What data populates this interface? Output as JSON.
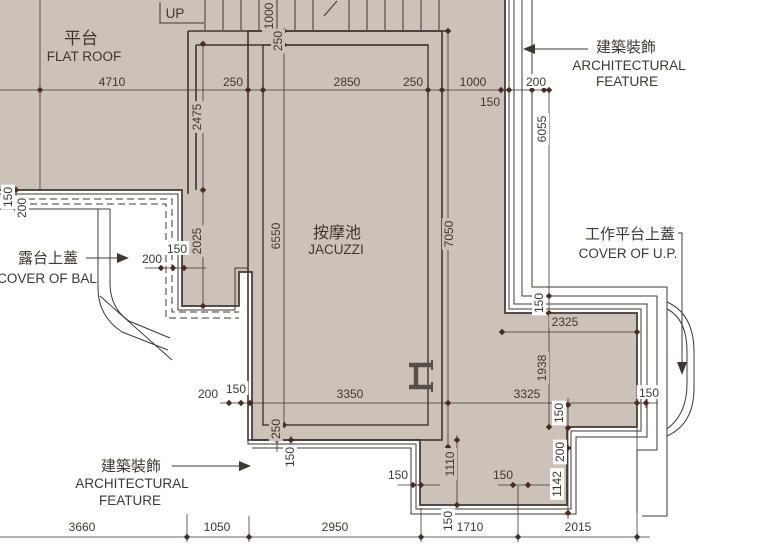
{
  "drawing": {
    "kind": "architectural-floor-plan"
  },
  "colors": {
    "fill": "#ccc2b9",
    "line": "#3e3731",
    "tick": "#4a2c20",
    "white": "#ffffff"
  },
  "labels": [
    {
      "t": "平台",
      "x": 81,
      "y": 44,
      "s": 17,
      "cls": "room-label-flat-roof-zh"
    },
    {
      "t": "FLAT ROOF",
      "x": 84,
      "y": 61,
      "s": 13.5,
      "cls": "room-label-flat-roof-en"
    },
    {
      "t": "UP",
      "x": 175,
      "y": 18,
      "s": 13.5,
      "cls": "stair-up-label"
    },
    {
      "t": "按摩池",
      "x": 337,
      "y": 238,
      "s": 16,
      "cls": "room-label-jacuzzi-zh"
    },
    {
      "t": "JACUZZI",
      "x": 336,
      "y": 254,
      "s": 13.5,
      "cls": "room-label-jacuzzi-en"
    },
    {
      "t": "建築裝飾",
      "x": 626,
      "y": 52,
      "s": 15,
      "cls": "annotation-arch-feature-top-zh"
    },
    {
      "t": "ARCHITECTURAL",
      "x": 629,
      "y": 70,
      "s": 13.5,
      "cls": "annotation-arch-feature-top-en1"
    },
    {
      "t": "FEATURE",
      "x": 627,
      "y": 86,
      "s": 13.5,
      "cls": "annotation-arch-feature-top-en2"
    },
    {
      "t": "露台上蓋",
      "x": 48,
      "y": 263,
      "s": 15,
      "cls": "annotation-cover-of-bal-zh"
    },
    {
      "t": "COVER OF BAL",
      "x": 47,
      "y": 283,
      "s": 13.5,
      "cls": "annotation-cover-of-bal-en"
    },
    {
      "t": "工作平台上蓋",
      "x": 630,
      "y": 239,
      "s": 15,
      "cls": "annotation-cover-of-up-zh"
    },
    {
      "t": "COVER OF U.P.",
      "x": 628,
      "y": 258,
      "s": 13.5,
      "cls": "annotation-cover-of-up-en"
    },
    {
      "t": "建築裝飾",
      "x": 131,
      "y": 471,
      "s": 15,
      "cls": "annotation-arch-feature-bottom-zh"
    },
    {
      "t": "ARCHITECTURAL",
      "x": 132,
      "y": 488,
      "s": 13.5,
      "cls": "annotation-arch-feature-bottom-en1"
    },
    {
      "t": "FEATURE",
      "x": 130,
      "y": 505,
      "s": 13.5,
      "cls": "annotation-arch-feature-bottom-en2"
    }
  ],
  "dim_labels": [
    {
      "t": "4710",
      "x": 112,
      "y": 86,
      "bg": "f"
    },
    {
      "t": "250",
      "x": 233,
      "y": 86,
      "bg": "f"
    },
    {
      "t": "2850",
      "x": 347,
      "y": 86,
      "bg": "f"
    },
    {
      "t": "250",
      "x": 413,
      "y": 86,
      "bg": "f"
    },
    {
      "t": "1000",
      "x": 473,
      "y": 86,
      "bg": "f"
    },
    {
      "t": "200",
      "x": 536,
      "y": 86,
      "bg": "w"
    },
    {
      "t": "150",
      "x": 490,
      "y": 106,
      "bg": "f"
    },
    {
      "t": "2325",
      "x": 565,
      "y": 326,
      "bg": "f"
    },
    {
      "t": "200",
      "x": 208,
      "y": 398,
      "bg": "w"
    },
    {
      "t": "150",
      "x": 236,
      "y": 393,
      "bg": "w"
    },
    {
      "t": "3350",
      "x": 350,
      "y": 398,
      "bg": "f"
    },
    {
      "t": "3325",
      "x": 527,
      "y": 398,
      "bg": "f"
    },
    {
      "t": "150",
      "x": 649,
      "y": 397,
      "bg": "w"
    },
    {
      "t": "200",
      "x": 152,
      "y": 263,
      "bg": "w"
    },
    {
      "t": "150",
      "x": 177,
      "y": 253,
      "bg": "w"
    },
    {
      "t": "150",
      "x": 398,
      "y": 479,
      "bg": "w"
    },
    {
      "t": "150",
      "x": 503,
      "y": 479,
      "bg": "f"
    },
    {
      "t": "3660",
      "x": 82,
      "y": 531,
      "bg": "w"
    },
    {
      "t": "1050",
      "x": 217,
      "y": 531,
      "bg": "w"
    },
    {
      "t": "2950",
      "x": 335,
      "y": 531,
      "bg": "w"
    },
    {
      "t": "1710",
      "x": 470,
      "y": 531,
      "bg": "w"
    },
    {
      "t": "2015",
      "x": 578,
      "y": 531,
      "bg": "w"
    },
    {
      "t": "2475",
      "x": 197,
      "y": 117,
      "r": 1,
      "bg": "f"
    },
    {
      "t": "2025",
      "x": 197,
      "y": 241,
      "r": 1,
      "bg": "f"
    },
    {
      "t": "6550",
      "x": 276,
      "y": 236,
      "r": 1,
      "bg": "f"
    },
    {
      "t": "7050",
      "x": 449,
      "y": 234,
      "r": 1,
      "bg": "f"
    },
    {
      "t": "1000",
      "x": 269,
      "y": 16,
      "r": 1,
      "bg": "f"
    },
    {
      "t": "250",
      "x": 278,
      "y": 41,
      "r": 1,
      "bg": "f"
    },
    {
      "t": "6055",
      "x": 542,
      "y": 129,
      "r": 1,
      "bg": "w"
    },
    {
      "t": "150",
      "x": 539,
      "y": 303,
      "r": 1,
      "bg": "w"
    },
    {
      "t": "1938",
      "x": 542,
      "y": 368,
      "r": 1,
      "bg": "f"
    },
    {
      "t": "1110",
      "x": 450,
      "y": 464,
      "r": 1,
      "bg": "f"
    },
    {
      "t": "150",
      "x": 559,
      "y": 413,
      "r": 1,
      "bg": "w"
    },
    {
      "t": "200",
      "x": 560,
      "y": 452,
      "r": 1,
      "bg": "w"
    },
    {
      "t": "1142",
      "x": 557,
      "y": 484,
      "r": 1,
      "bg": "w"
    },
    {
      "t": "250",
      "x": 276,
      "y": 429,
      "r": 1,
      "bg": "f"
    },
    {
      "t": "150",
      "x": 290,
      "y": 457,
      "r": 1,
      "bg": "w"
    },
    {
      "t": "150",
      "x": 8,
      "y": 197,
      "r": 1,
      "bg": "w"
    },
    {
      "t": "200",
      "x": 22,
      "y": 208,
      "r": 1,
      "bg": "w"
    },
    {
      "t": "150",
      "x": 448,
      "y": 521,
      "r": 1,
      "bg": "w"
    }
  ],
  "ticks": [
    [
      40,
      90
    ],
    [
      248,
      90
    ],
    [
      263,
      90
    ],
    [
      428,
      90
    ],
    [
      442,
      90
    ],
    [
      501,
      90
    ],
    [
      509,
      90
    ],
    [
      532,
      90
    ],
    [
      544,
      90
    ],
    [
      229,
      403
    ],
    [
      241,
      403
    ],
    [
      250,
      403
    ],
    [
      448,
      403
    ],
    [
      637,
      403
    ],
    [
      646,
      403
    ],
    [
      161,
      268
    ],
    [
      173,
      268
    ],
    [
      184,
      268
    ],
    [
      187,
      537
    ],
    [
      249,
      537
    ],
    [
      421,
      537
    ],
    [
      518,
      537
    ],
    [
      637,
      537
    ],
    [
      203,
      44
    ],
    [
      203,
      190
    ],
    [
      203,
      306
    ],
    [
      284,
      31
    ],
    [
      284,
      45
    ],
    [
      284,
      425
    ],
    [
      448,
      31
    ],
    [
      448,
      447
    ],
    [
      549,
      90
    ],
    [
      549,
      296
    ],
    [
      549,
      313
    ],
    [
      549,
      427
    ],
    [
      502,
      332
    ],
    [
      637,
      332
    ],
    [
      568,
      405
    ],
    [
      568,
      428
    ],
    [
      568,
      448
    ],
    [
      568,
      513
    ],
    [
      16,
      190
    ],
    [
      16,
      198
    ],
    [
      16,
      209
    ],
    [
      413,
      485
    ],
    [
      421,
      485
    ],
    [
      513,
      485
    ],
    [
      528,
      485
    ],
    [
      277,
      425
    ],
    [
      277,
      440
    ],
    [
      291,
      440
    ],
    [
      291,
      449
    ],
    [
      457,
      440
    ],
    [
      457,
      505
    ]
  ]
}
